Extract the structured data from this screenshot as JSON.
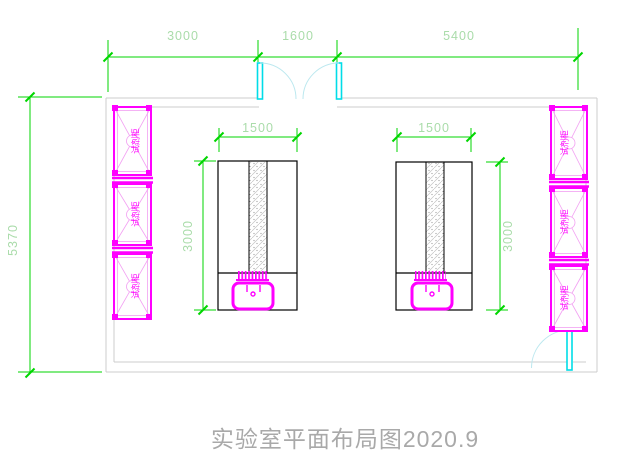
{
  "title": {
    "text": "实验室平面布局图2020.9"
  },
  "dimensions": {
    "top": {
      "left": "3000",
      "middle": "1600",
      "right": "5400"
    },
    "overall_height": "5370",
    "left_bench": {
      "width": "1500",
      "length": "3000"
    },
    "right_bench": {
      "width": "1500",
      "length": "3000"
    }
  },
  "cabinets": {
    "left": [
      {
        "label": "试剂柜"
      },
      {
        "label": "试剂柜"
      },
      {
        "label": "试剂柜"
      }
    ],
    "right": [
      {
        "label": "试剂柜"
      },
      {
        "label": "试剂柜"
      },
      {
        "label": "试剂柜"
      }
    ]
  },
  "colors": {
    "dimension_line": "#00d600",
    "dimension_text": "#aadcaa",
    "wall": "#cccccc",
    "cabinet": "#ff00ff",
    "cabinet_detail": "#f2a0f2",
    "door_leaf": "#00dde8",
    "door_swing": "#bce8ef",
    "bench_outline": "#000000",
    "sink": "#ff00ff",
    "title_text": "#a9a9a9"
  }
}
